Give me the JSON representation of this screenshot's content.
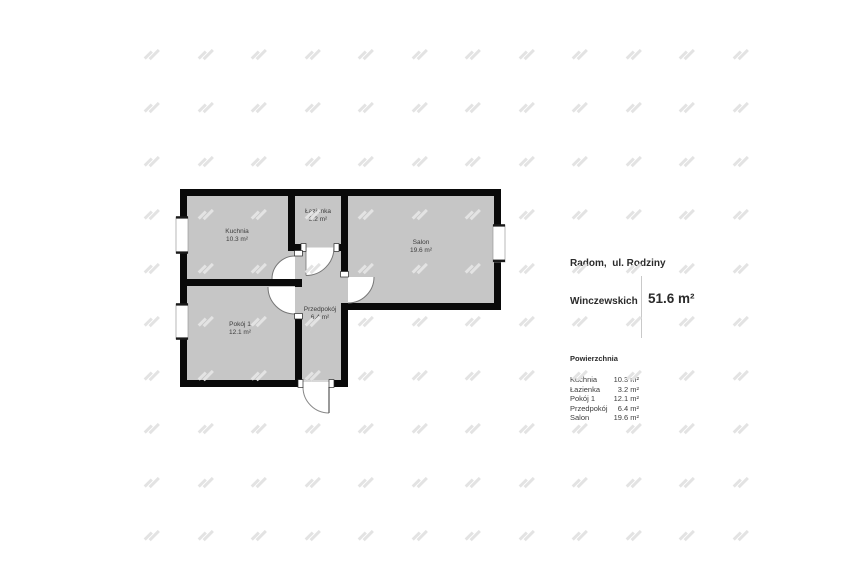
{
  "floor_plan": {
    "rooms": [
      {
        "id": "kuchnia",
        "name": "Kuchnia",
        "area": "10.3 m²"
      },
      {
        "id": "lazienka",
        "name": "Łazienka",
        "area": "3.2 m²"
      },
      {
        "id": "salon",
        "name": "Salon",
        "area": "19.6 m²"
      },
      {
        "id": "pokoj1",
        "name": "Pokój 1",
        "area": "12.1 m²"
      },
      {
        "id": "przedpokoj",
        "name": "Przedpokój",
        "area": "6.4 m²"
      }
    ]
  },
  "info_panel": {
    "address_line1": "Radom,  ul. Rodziny",
    "address_line2": "Winczewskich",
    "table_header": "Powierzchnia",
    "rows": [
      {
        "label": "Kuchnia",
        "value": "10.3 m²"
      },
      {
        "label": "Łazienka",
        "value": "3.2 m²"
      },
      {
        "label": "Pokój 1",
        "value": "12.1 m²"
      },
      {
        "label": "Przedpokój",
        "value": "6.4 m²"
      },
      {
        "label": "Salon",
        "value": "19.6 m²"
      }
    ],
    "total_area": "51.6 m²"
  },
  "colors": {
    "wall": "#0a0a0a",
    "floor_fill": "#c6c6c6",
    "watermark": "#e3e3e3",
    "text": "#2b2b2b"
  }
}
